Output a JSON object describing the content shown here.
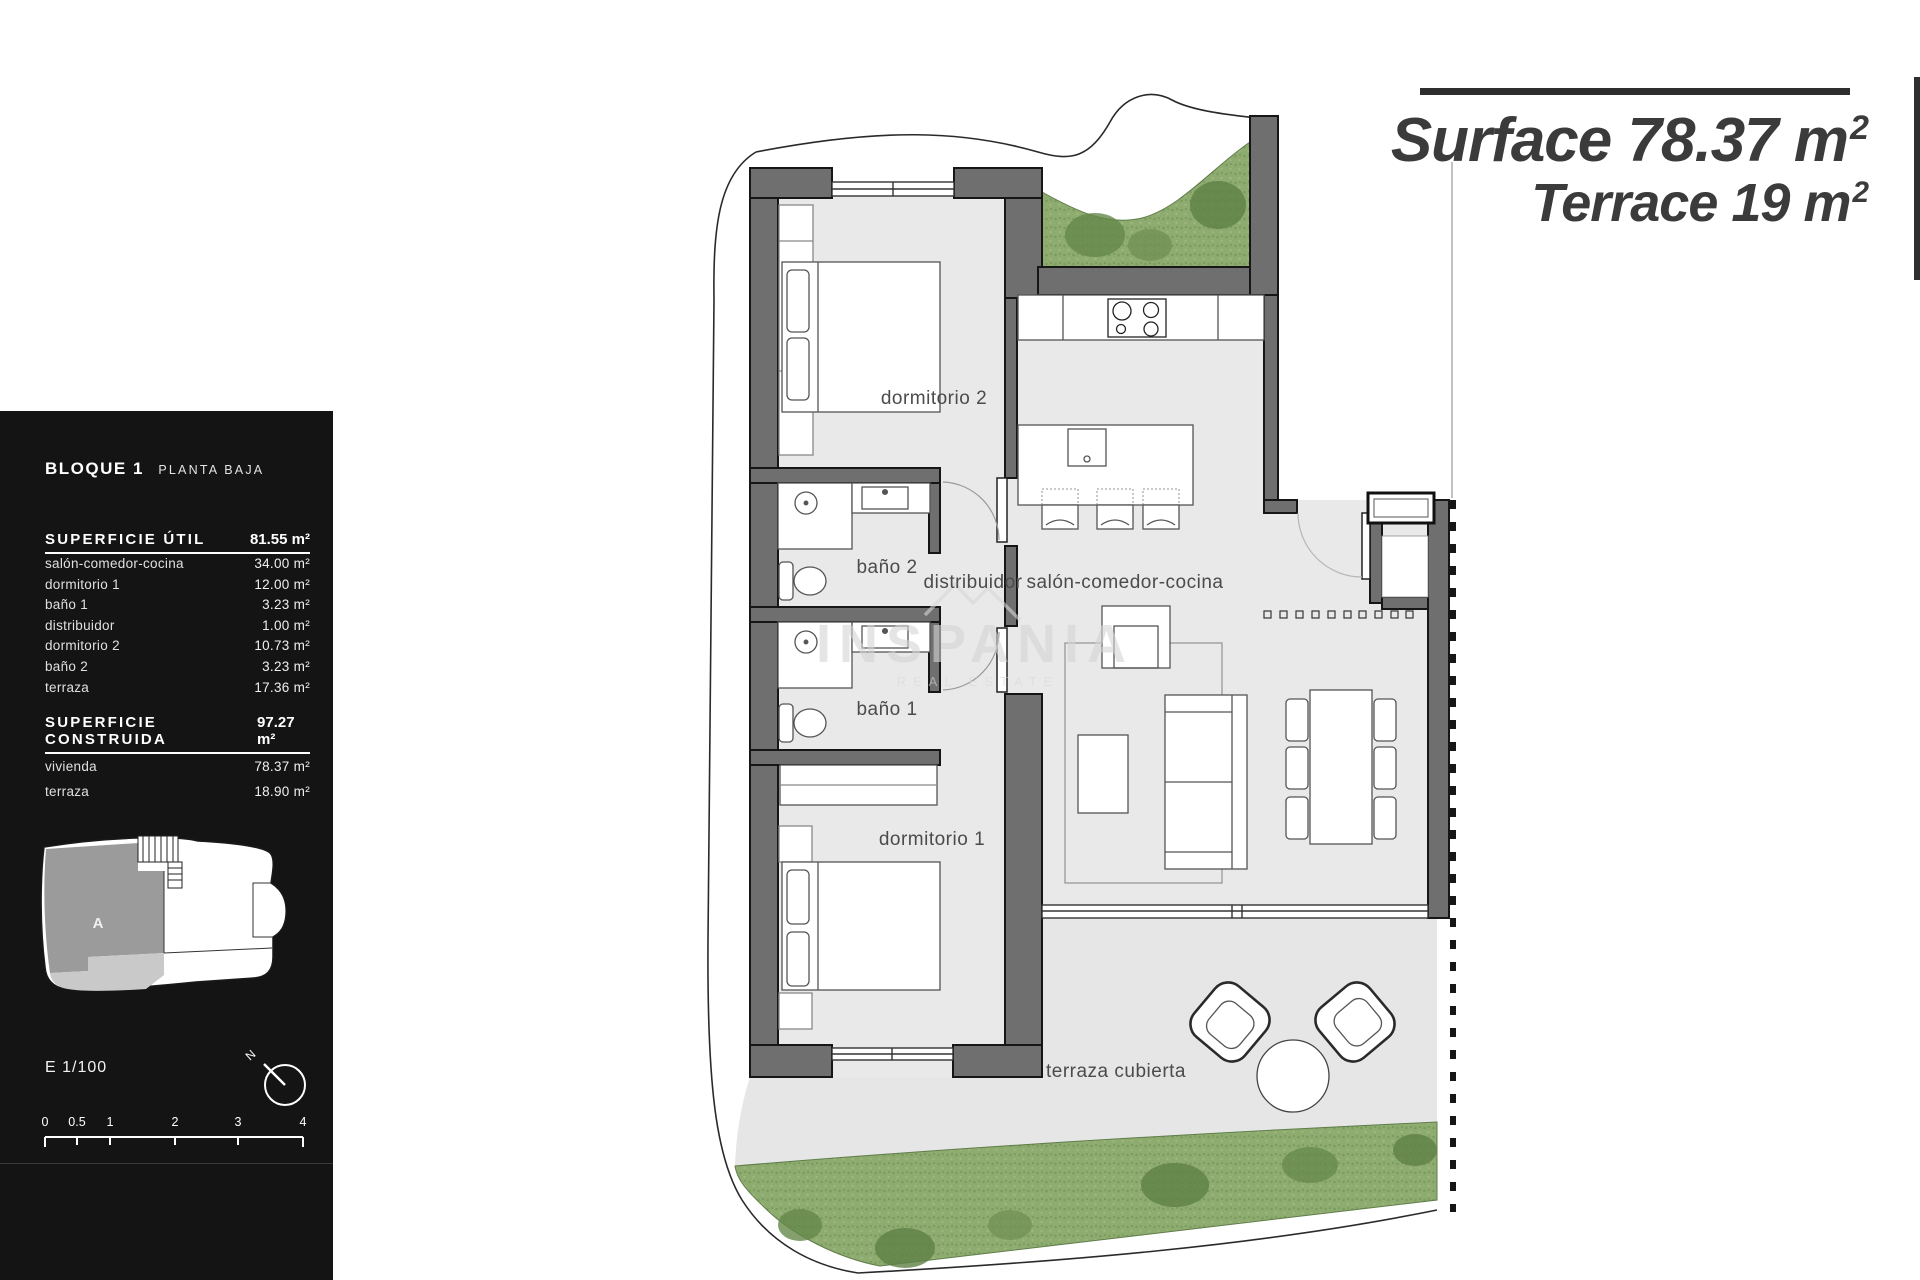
{
  "header": {
    "line1": {
      "label": "Surface",
      "value": "78.37",
      "unit_base": "m",
      "unit_sup": "2"
    },
    "line2": {
      "label": "Terrace",
      "value": "19",
      "unit_base": "m",
      "unit_sup": "2"
    }
  },
  "sidebar": {
    "block_title": "BLOQUE 1",
    "block_subtitle": "PLANTA BAJA",
    "util": {
      "title": "SUPERFICIE ÚTIL",
      "total": "81.55 m²",
      "rows": [
        {
          "label": "salón-comedor-cocina",
          "value": "34.00 m²"
        },
        {
          "label": "dormitorio 1",
          "value": "12.00 m²"
        },
        {
          "label": "baño 1",
          "value": "3.23 m²"
        },
        {
          "label": "distribuidor",
          "value": "1.00 m²"
        },
        {
          "label": "dormitorio 2",
          "value": "10.73 m²"
        },
        {
          "label": "baño 2",
          "value": "3.23 m²"
        },
        {
          "label": "terraza",
          "value": "17.36 m²"
        }
      ]
    },
    "construida": {
      "title": "SUPERFICIE CONSTRUIDA",
      "total": "97.27 m²",
      "rows": [
        {
          "label": "vivienda",
          "value": "78.37 m²"
        },
        {
          "label": "terraza",
          "value": "18.90 m²"
        }
      ]
    },
    "keyplan_label": "A",
    "scale_text": "E 1/100",
    "compass_label": "N",
    "scalebar_ticks": [
      "0",
      "0.5",
      "1",
      "2",
      "3",
      "4"
    ]
  },
  "plan": {
    "rooms": {
      "dormitorio2": "dormitorio 2",
      "bano2": "baño 2",
      "distribuidor": "distribuidor",
      "salon": "salón-comedor-cocina",
      "bano1": "baño 1",
      "dormitorio1": "dormitorio 1",
      "terraza": "terraza cubierta"
    },
    "watermark": {
      "text": "INSPANIA",
      "subtext": "REAL ESTATE"
    }
  },
  "colors": {
    "wall": "#6f6f70",
    "floor": "#e9e9ea",
    "grass": "#8fac70",
    "panel": "#141414",
    "accent_text": "#3b3b3b"
  }
}
